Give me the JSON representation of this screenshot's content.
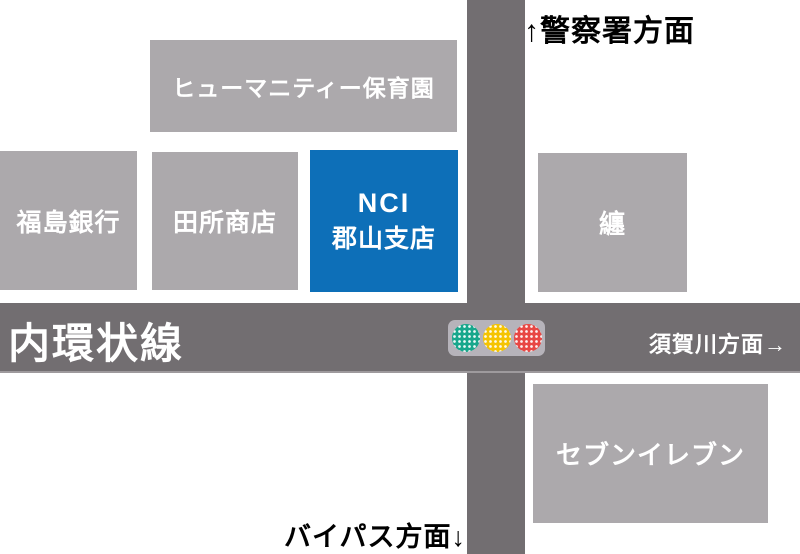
{
  "colors": {
    "background": "#FFFFFF",
    "building_gray": "#ACA9AC",
    "road_gray": "#726E71",
    "highlight_blue": "#0D6FB8",
    "label_white": "#FFFFFF",
    "label_black": "#000000",
    "signal_housing": "#B6B3BA"
  },
  "roads": {
    "horizontal_label": "内環状線"
  },
  "directions": {
    "north": "↑警察署方面",
    "east": "須賀川方面→",
    "south": "バイパス方面↓"
  },
  "buildings": [
    {
      "id": "humanity-nursery",
      "label": "ヒューマニティー保育園"
    },
    {
      "id": "fukushima-bank",
      "label": "福島銀行"
    },
    {
      "id": "tadokoro-shoten",
      "label": "田所商店"
    },
    {
      "id": "nci-koriyama-branch",
      "lines": [
        "NCI",
        "郡山支店"
      ],
      "highlight": true
    },
    {
      "id": "matoi",
      "label": "纏"
    },
    {
      "id": "seven-eleven",
      "label": "セブンイレブン"
    }
  ],
  "traffic_light": {
    "lights": [
      {
        "name": "green",
        "color": "#18A78C"
      },
      {
        "name": "yellow",
        "color": "#F5C402"
      },
      {
        "name": "red",
        "color": "#E84744"
      }
    ]
  }
}
